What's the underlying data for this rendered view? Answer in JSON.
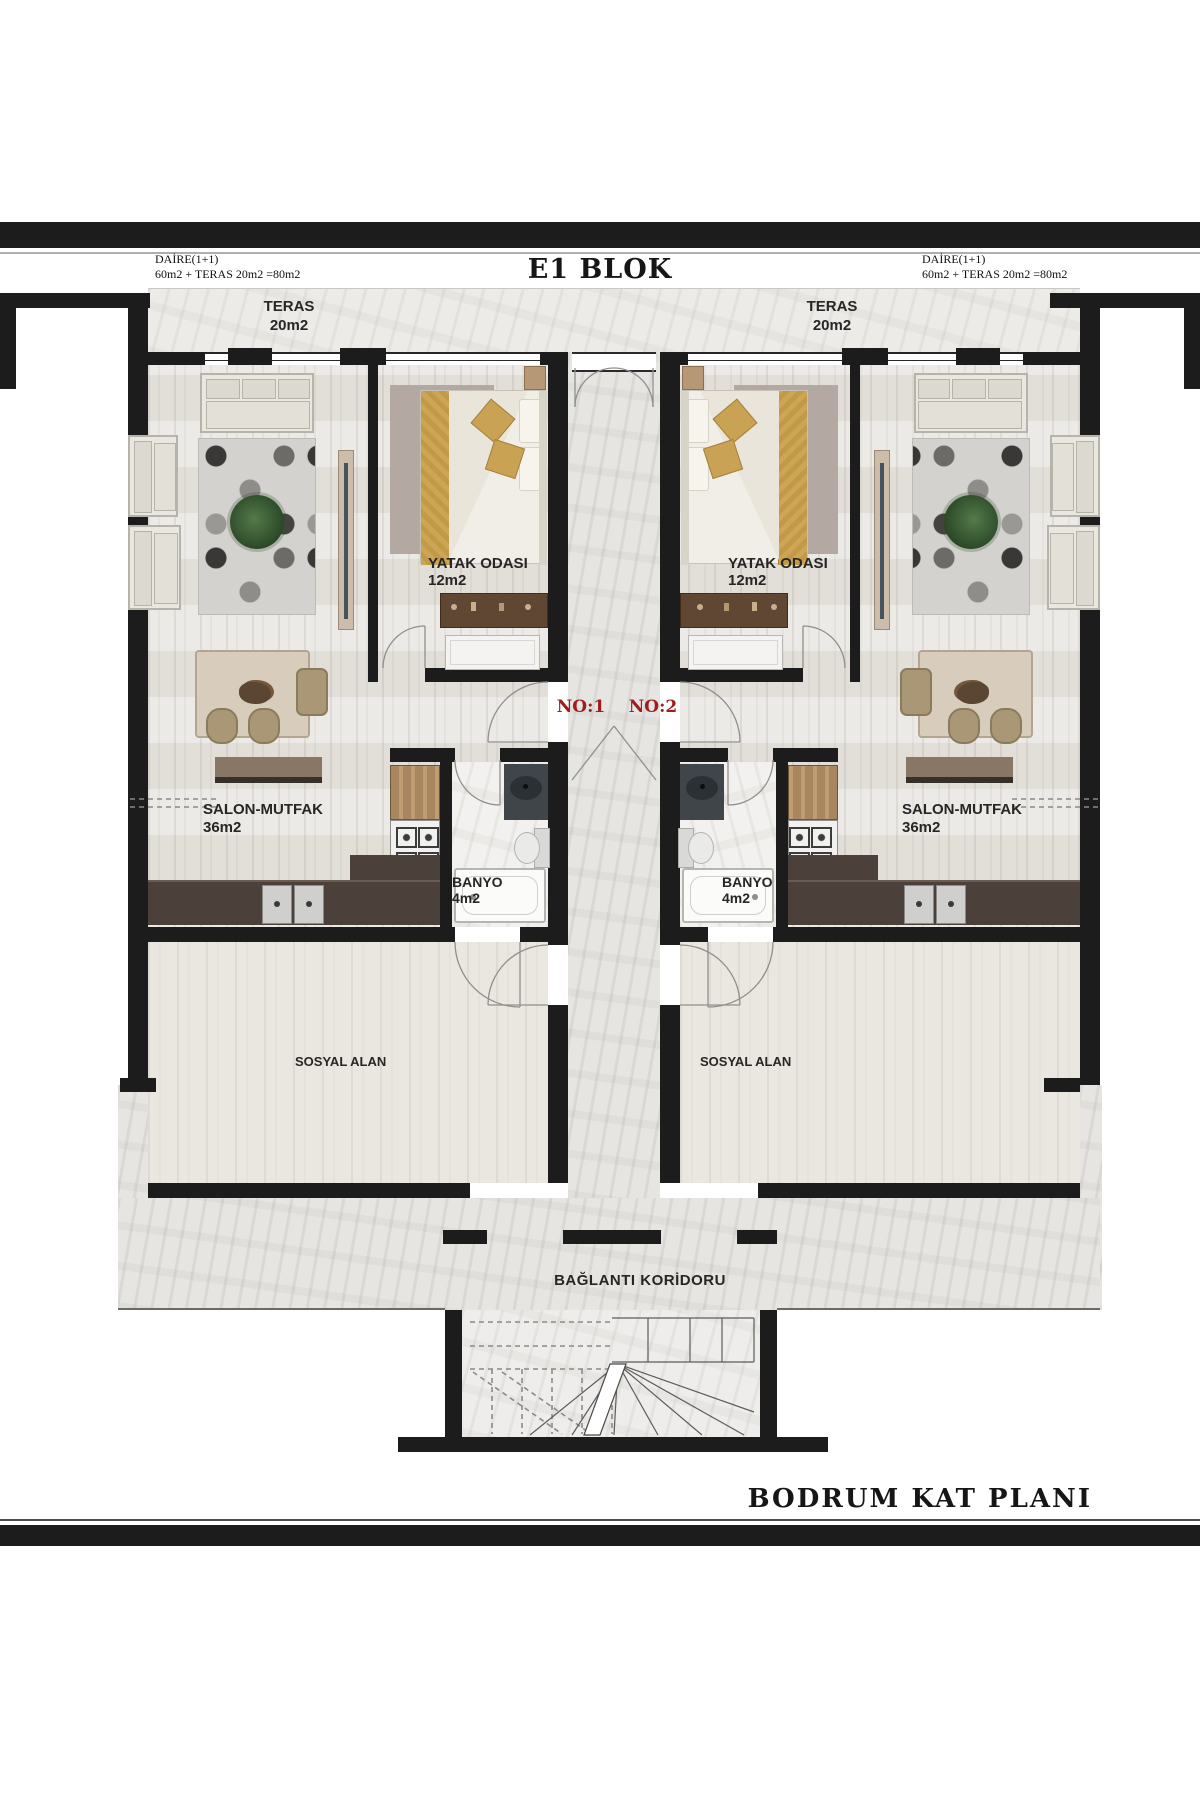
{
  "header": {
    "title": "E1 BLOK",
    "left_spec": {
      "line1": "DAİRE(1+1)",
      "line2": "60m2 + TERAS 20m2 =80m2"
    },
    "right_spec": {
      "line1": "DAİRE(1+1)",
      "line2": "60m2 + TERAS 20m2 =80m2"
    }
  },
  "labels": {
    "no1": "NO:1",
    "no2": "NO:2"
  },
  "rooms": {
    "teras": {
      "name": "TERAS",
      "area": "20m2"
    },
    "yatak": {
      "name": "YATAK ODASI",
      "area": "12m2"
    },
    "salon": {
      "name": "SALON-MUTFAK",
      "area": "36m2"
    },
    "banyo": {
      "name": "BANYO",
      "area": "4m2"
    },
    "sosyal": {
      "name": "SOSYAL ALAN"
    },
    "koridor": {
      "name": "BAĞLANTI KORİDORU"
    }
  },
  "footer": {
    "title": "BODRUM KAT PLANI"
  },
  "colors": {
    "wall": "#1c1c1c",
    "unit_number_red": "#9e1d1d",
    "wood_floor": "#e6e3dd",
    "marble_floor": "#edebe8",
    "kitchen_counter": "#4c413a",
    "cabinet_wood": "#a3835d",
    "bed_blanket_gold": "#cda554",
    "label_text": "#262626"
  }
}
